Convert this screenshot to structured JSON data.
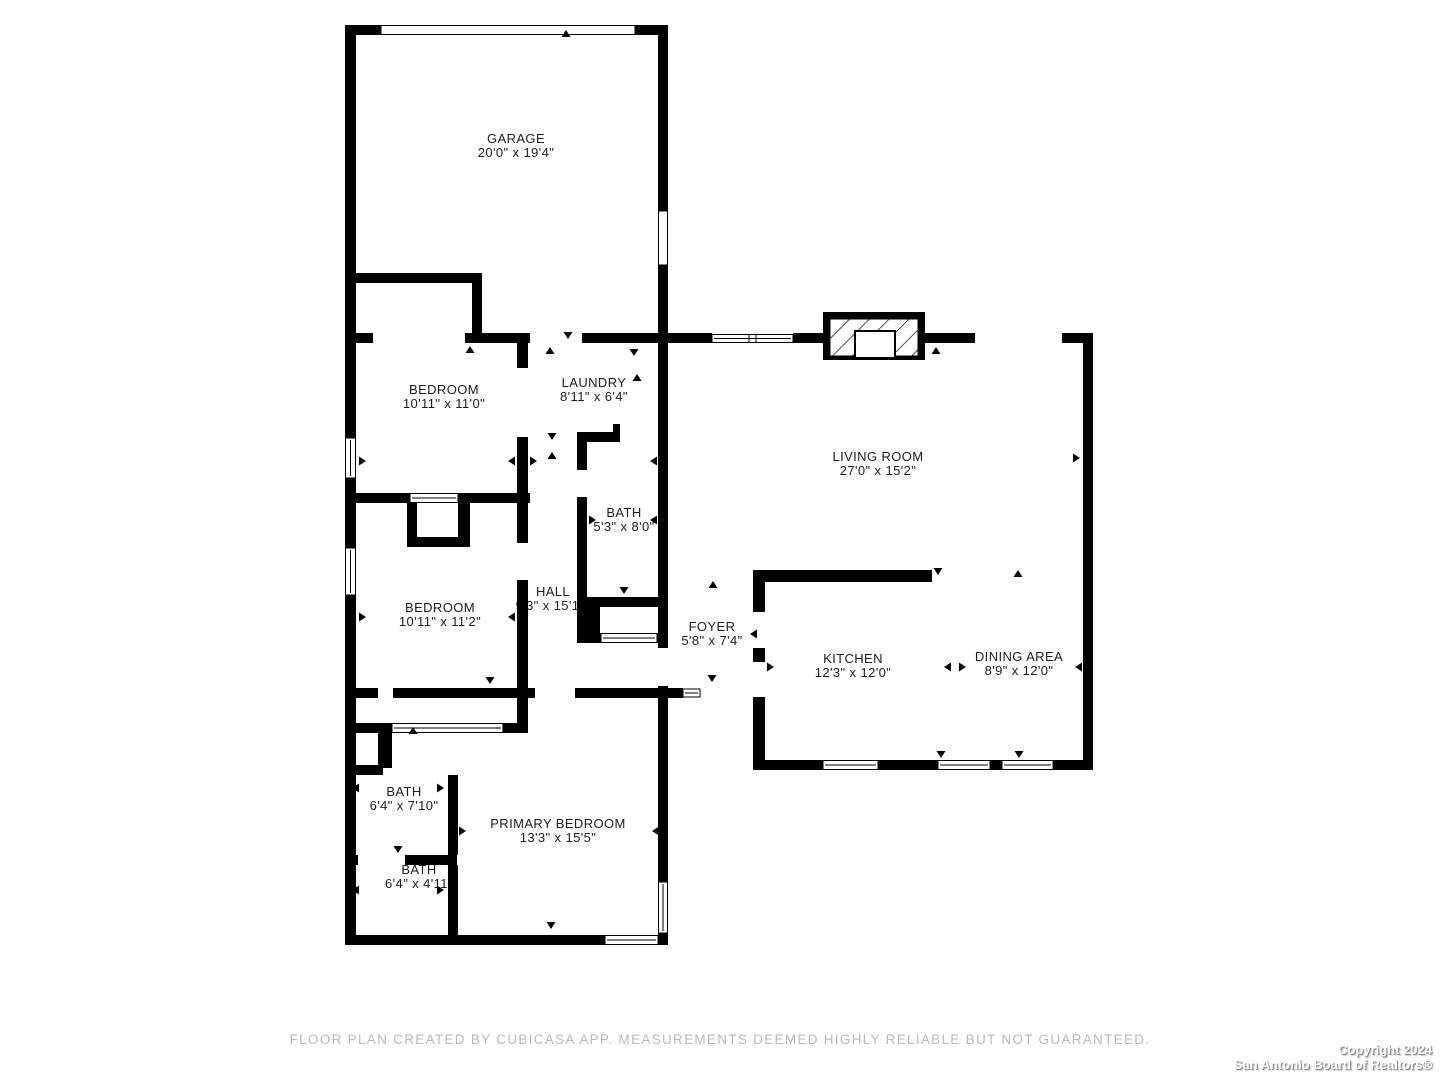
{
  "rooms": {
    "garage": {
      "name": "GARAGE",
      "dims": "20'0\" x 19'4\""
    },
    "bedroom_top": {
      "name": "BEDROOM",
      "dims": "10'11\" x 11'0\""
    },
    "laundry": {
      "name": "LAUNDRY",
      "dims": "8'11\" x 6'4\""
    },
    "living_room": {
      "name": "LIVING ROOM",
      "dims": "27'0\" x 15'2\""
    },
    "bath_hall": {
      "name": "BATH",
      "dims": "5'3\" x 8'0\""
    },
    "bedroom_mid": {
      "name": "BEDROOM",
      "dims": "10'11\" x 11'2\""
    },
    "hall": {
      "name": "HALL",
      "dims": "9'3\" x 15'1\""
    },
    "foyer": {
      "name": "FOYER",
      "dims": "5'8\" x 7'4\""
    },
    "kitchen": {
      "name": "KITCHEN",
      "dims": "12'3\" x 12'0\""
    },
    "dining": {
      "name": "DINING AREA",
      "dims": "8'9\" x 12'0\""
    },
    "bath_primary": {
      "name": "BATH",
      "dims": "6'4\" x 7'10\""
    },
    "bath_small": {
      "name": "BATH",
      "dims": "6'4\" x 4'11\""
    },
    "primary_bedroom": {
      "name": "PRIMARY BEDROOM",
      "dims": "13'3\" x 15'5\""
    }
  },
  "footer": {
    "disclaimer": "FLOOR PLAN CREATED BY CUBICASA APP. MEASUREMENTS DEEMED HIGHLY RELIABLE BUT NOT GUARANTEED."
  },
  "watermark": {
    "line1": "Copyright 2024",
    "line2": "San Antonio Board of Realtors®"
  },
  "colors": {
    "wall": "#000000",
    "label_text": "#1c1c1c",
    "disclaimer_text": "#b9b9b9",
    "watermark_text": "#ffffff"
  }
}
